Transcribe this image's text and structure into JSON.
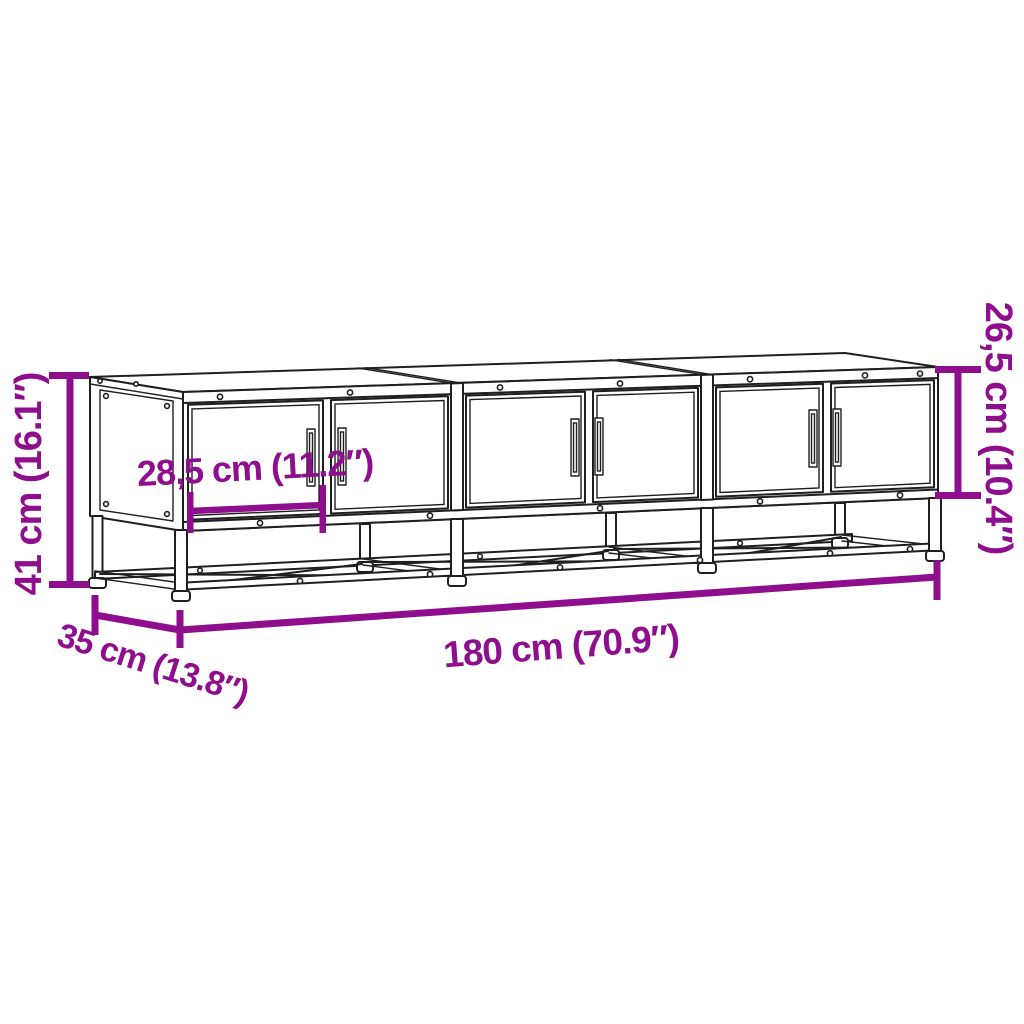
{
  "figure": {
    "object": "tv-cabinet-with-six-doors-on-metal-base-frame",
    "colors": {
      "accent": "#8E0E8E",
      "line": "#1f1f1f",
      "background": "#ffffff"
    },
    "dimensions": {
      "overall_height": {
        "label": "41 cm (16.1″)",
        "cm": 41,
        "inches": 16.1,
        "placement": "left-vertical"
      },
      "body_height": {
        "label": "26,5 cm (10.4″)",
        "cm": 26.5,
        "inches": 10.4,
        "placement": "right-vertical"
      },
      "overall_width": {
        "label": "180 cm (70.9″)",
        "cm": 180,
        "inches": 70.9,
        "placement": "bottom"
      },
      "depth": {
        "label": "35 cm (13.8″)",
        "cm": 35,
        "inches": 13.8,
        "placement": "bottom-left-diagonal"
      },
      "door_width": {
        "label": "28,5 cm (11.2″)",
        "cm": 28.5,
        "inches": 11.2,
        "placement": "on-left-door"
      }
    }
  }
}
